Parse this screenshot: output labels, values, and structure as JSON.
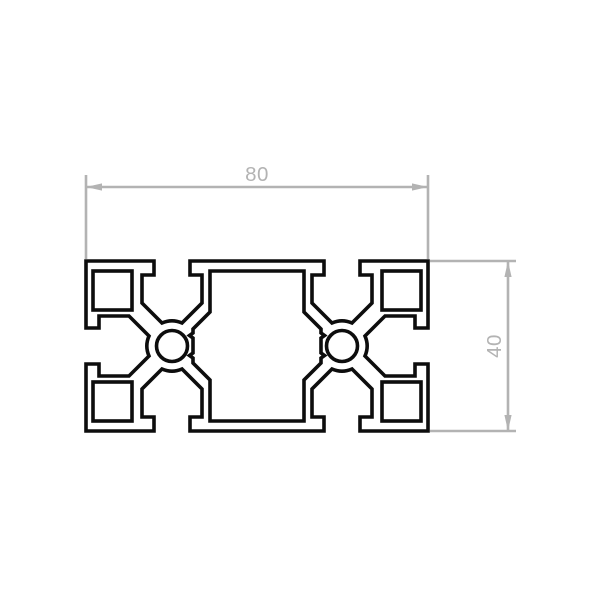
{
  "drawing": {
    "type": "aluminium-profile-cross-section",
    "dimensions": {
      "width": {
        "label": "80"
      },
      "height": {
        "label": "40"
      }
    },
    "colors": {
      "profile": "#0d0d0d",
      "dimension": "#b3b3b3",
      "background": "#ffffff"
    }
  }
}
